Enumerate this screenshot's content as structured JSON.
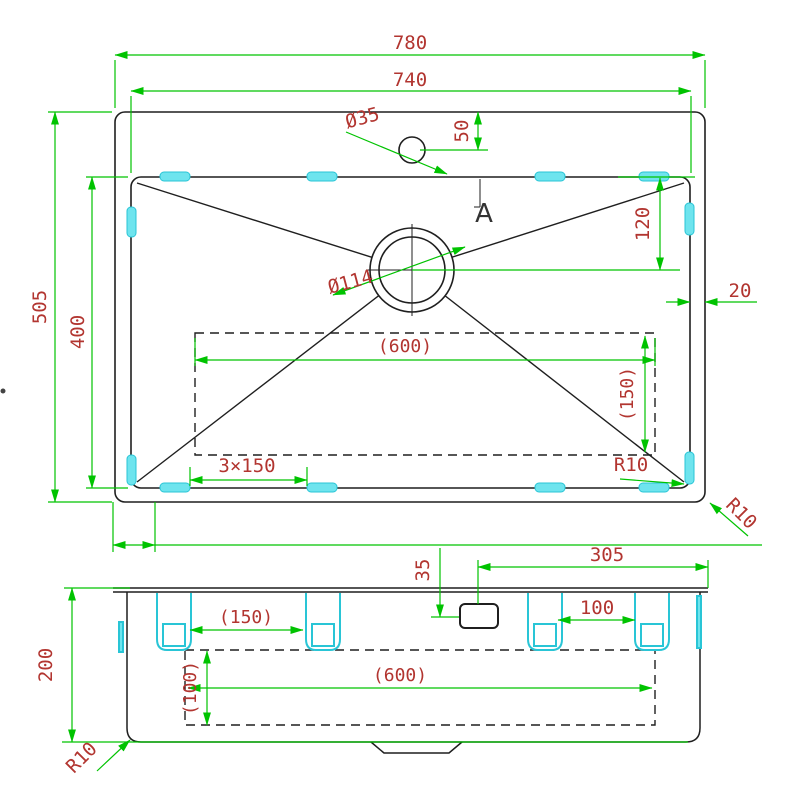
{
  "drawing": {
    "label": "Kitchen sink dimensional drawing",
    "colors": {
      "dim_line": "#00c300",
      "dim_text": "#b23530",
      "outline": "#1f1f1f",
      "clip": "#6ee4ee"
    },
    "top_view": {
      "overall_width": "780",
      "bowl_width": "740",
      "overall_depth": "505",
      "bowl_depth": "400",
      "faucet_hole_dia": "Ø35",
      "faucet_hole_offset": "50",
      "drain_dia": "Ø114",
      "drain_offset": "120",
      "rim_gap": "20",
      "cutout_width": "(600)",
      "cutout_depth": "(150)",
      "clip_pitch": "3×150",
      "bowl_radius": "R10",
      "corner_radius": "R10",
      "section_label": "A"
    },
    "front_view": {
      "depth": "200",
      "overflow_drop": "35",
      "overflow_offset": "305",
      "clip_pitch_left": "(150)",
      "clip_pitch_right": "100",
      "cutout_width": "(600)",
      "cutout_depth": "(100)",
      "corner_radius": "R10"
    }
  }
}
